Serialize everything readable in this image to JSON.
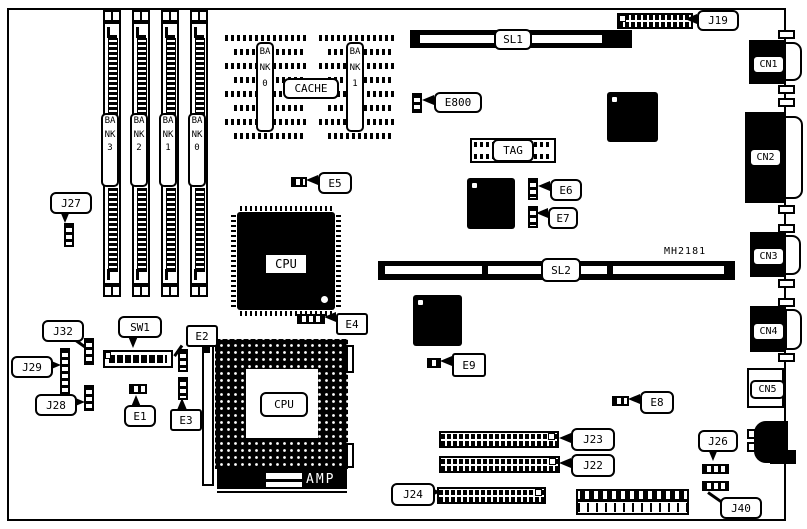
{
  "part_number": "MH2181",
  "memory": {
    "simm_slots": [
      {
        "label": "BANK3"
      },
      {
        "label": "BANK2"
      },
      {
        "label": "BANK1"
      },
      {
        "label": "BANK0"
      }
    ],
    "cache": {
      "bank0": "BANK0",
      "title": "CACHE",
      "bank1": "BANK1",
      "tag": "TAG"
    }
  },
  "slots": {
    "sl1": "SL1",
    "sl2": "SL2"
  },
  "processors": {
    "cpu_qfp": "CPU",
    "cpu_socket": "CPU"
  },
  "regulator": {
    "amp": "AMP"
  },
  "jumpers": {
    "e1": "E1",
    "e2": "E2",
    "e3": "E3",
    "e4": "E4",
    "e5": "E5",
    "e6": "E6",
    "e7": "E7",
    "e8": "E8",
    "e9": "E9",
    "e800": "E800"
  },
  "switches": {
    "sw1": "SW1"
  },
  "headers": {
    "j19": "J19",
    "j22": "J22",
    "j23": "J23",
    "j24": "J24",
    "j26": "J26",
    "j27": "J27",
    "j28": "J28",
    "j29": "J29",
    "j32": "J32",
    "j40": "J40"
  },
  "rear_ports": {
    "cn1": "CN1",
    "cn2": "CN2",
    "cn3": "CN3",
    "cn4": "CN4",
    "cn5": "CN5"
  },
  "colors": {
    "ink": "#000000",
    "paper": "#ffffff"
  }
}
